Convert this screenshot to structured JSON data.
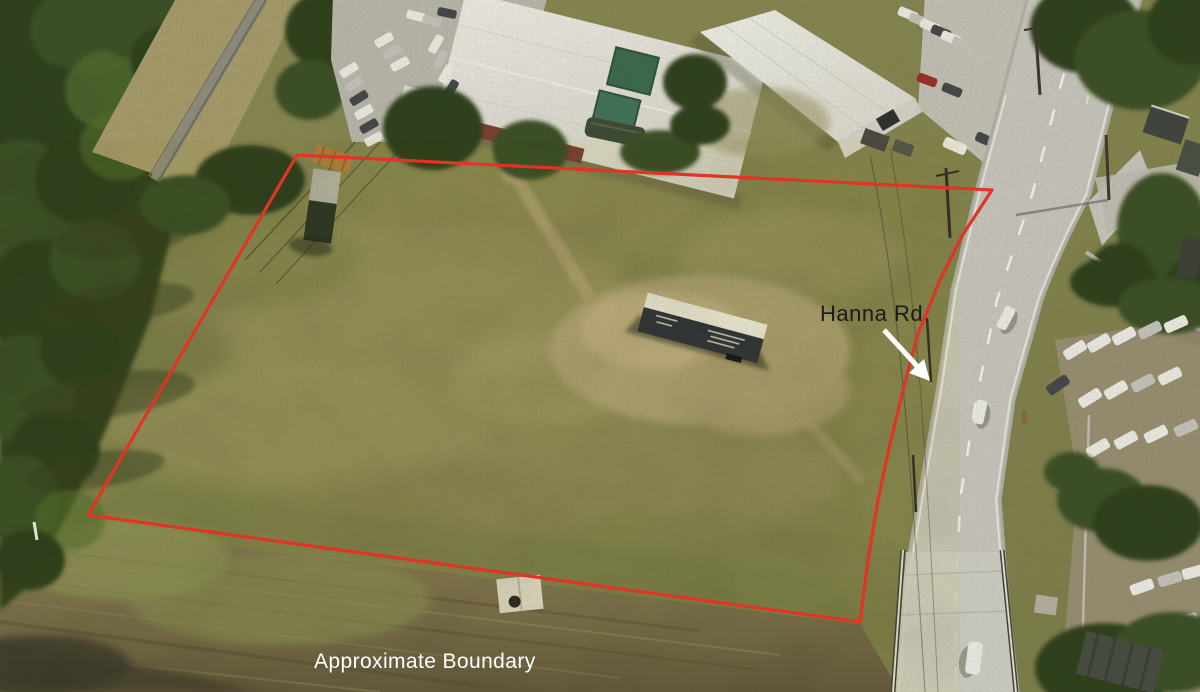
{
  "meta": {
    "type": "aerial-drone-photograph",
    "subject": "Vacant land parcel outlined in red beside Hanna Rd",
    "width_px": 1200,
    "height_px": 692
  },
  "annotations": {
    "road_label": "Hanna Rd",
    "road_label_color": "#1b1b1b",
    "arrow_color": "#ffffff",
    "boundary_label": "Approximate Boundary",
    "boundary_label_color": "#ffffff",
    "boundary_color": "#e03425"
  },
  "palette": {
    "grass_base": "#86854f",
    "grass_dry": "#b2a378",
    "trees": "#2f3f1d",
    "road": "#cac8c0",
    "soil": "#6b6145",
    "roof_white": "#e9e7df",
    "wall_red": "#7d4032",
    "canopy_green": "#3f7051",
    "container_orange": "#b5803f",
    "trailer_side": "#30343a",
    "trailer_roof": "#ece9e0"
  }
}
